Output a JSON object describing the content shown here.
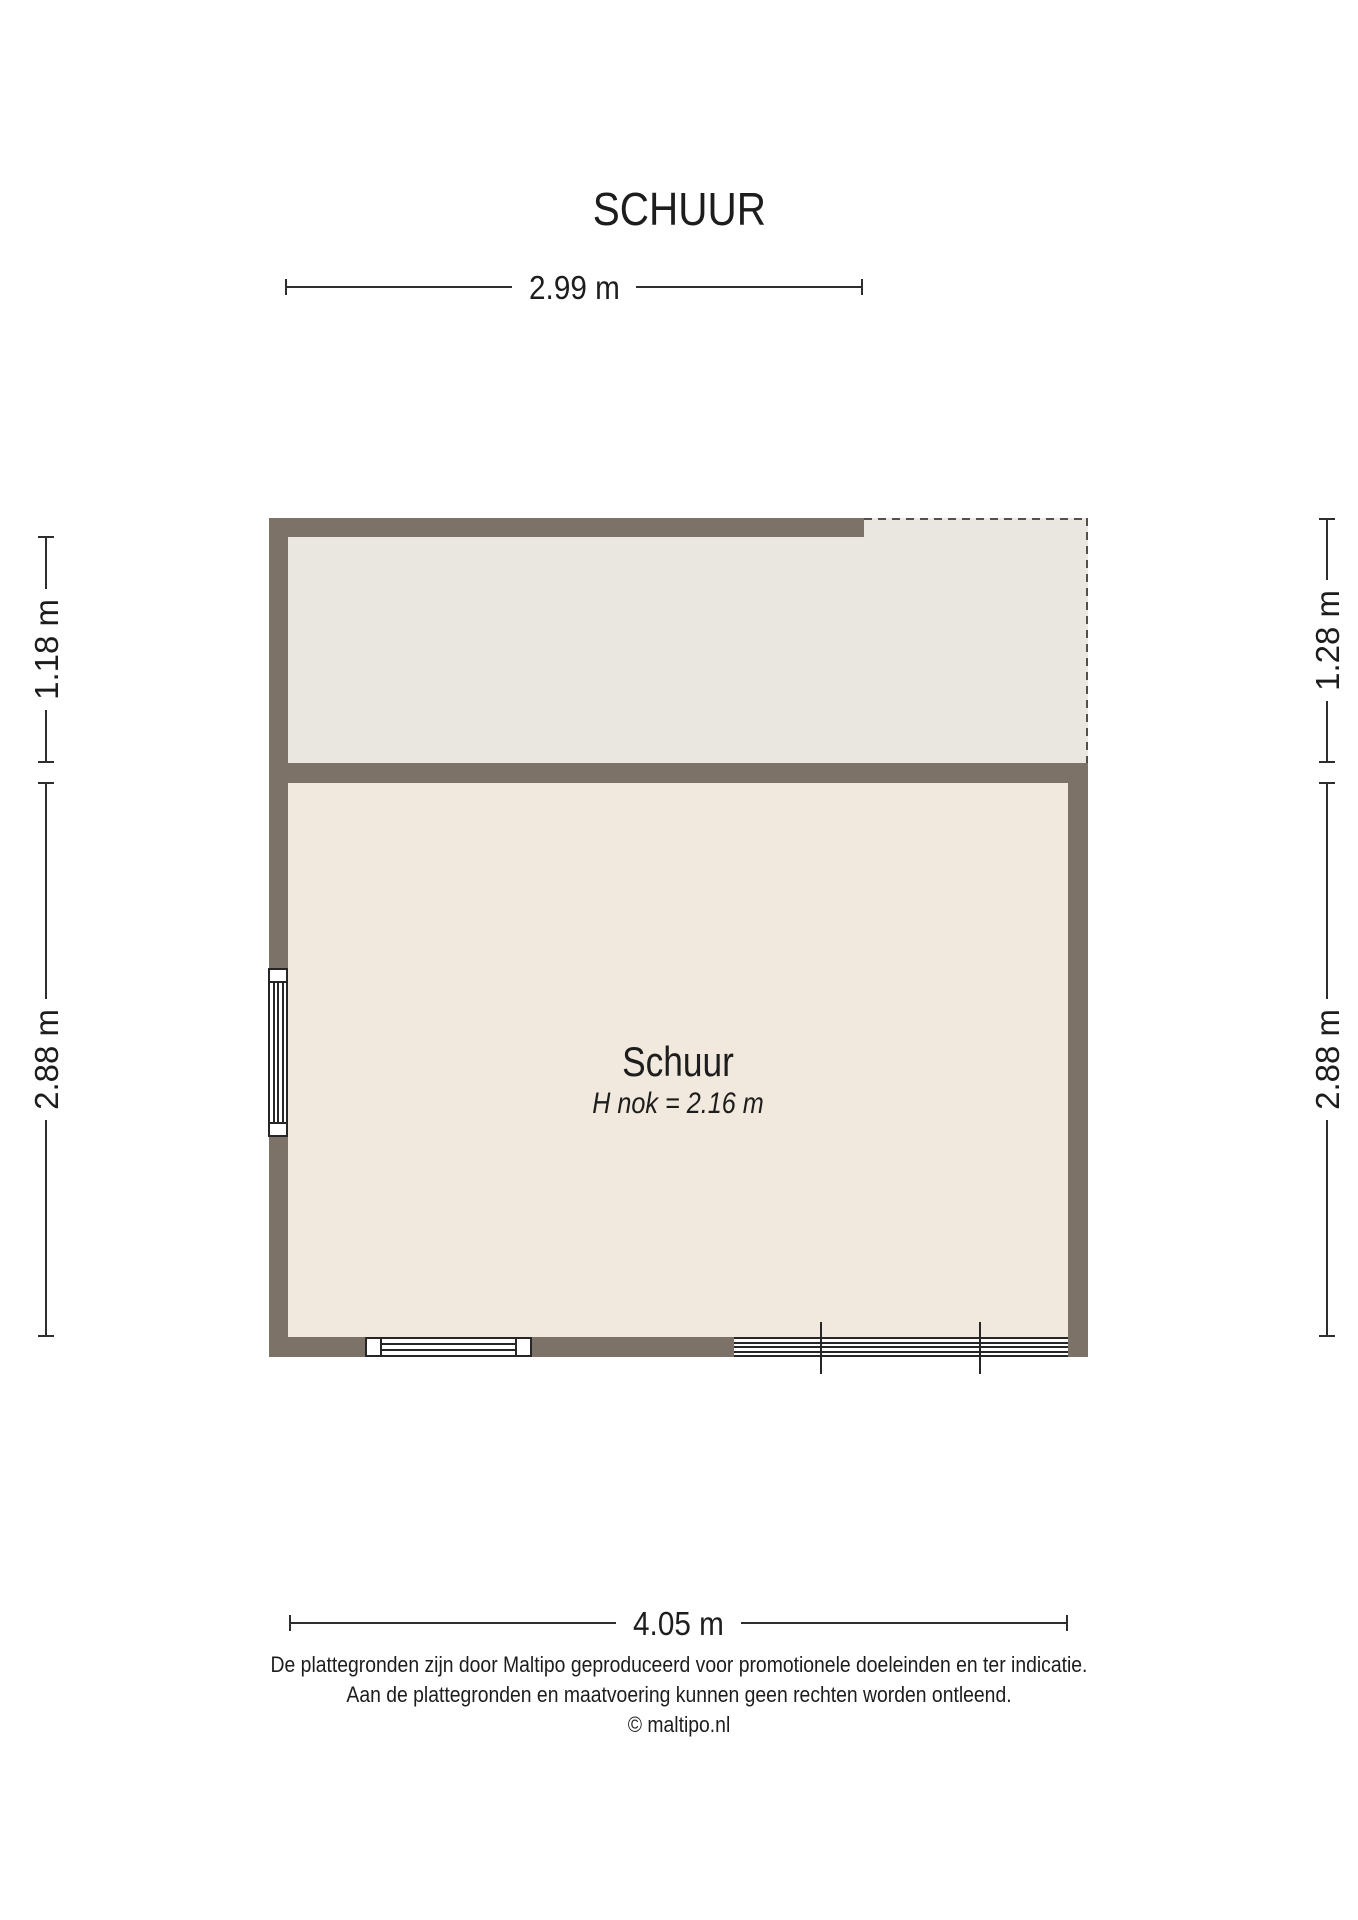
{
  "title": "SCHUUR",
  "dimensions": {
    "top": "2.99 m",
    "bottom": "4.05 m",
    "left_upper": "1.18 m",
    "left_lower": "2.88 m",
    "right_upper": "1.28 m",
    "right_lower": "2.88 m"
  },
  "room": {
    "name": "Schuur",
    "height_note": "H nok = 2.16 m"
  },
  "footer": {
    "line1": "De plattegronden zijn door Maltipo geproduceerd voor promotionele doeleinden en ter indicatie.",
    "line2": "Aan de plattegronden en maatvoering kunnen geen rechten worden ontleend.",
    "line3": "© maltipo.nl"
  },
  "colors": {
    "wall": "#7d7267",
    "area_open": "#e9e7e0",
    "area_room": "#f1e9dd",
    "dash": "#55504a",
    "ink": "#1d1d1d",
    "line": "#2e2e2e",
    "frame": "#262626"
  }
}
